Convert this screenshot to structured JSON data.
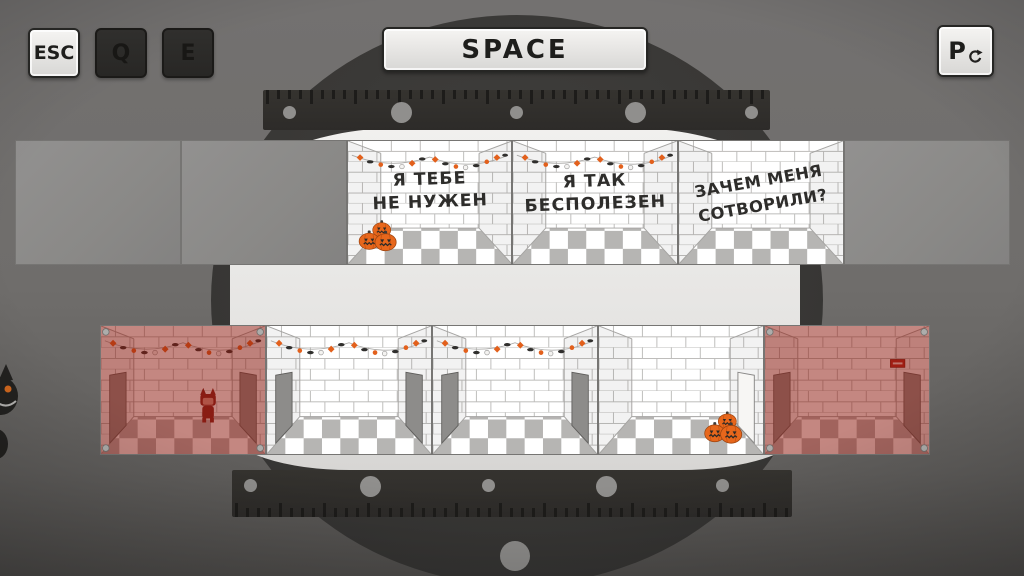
{
  "hud": {
    "keys": {
      "esc": {
        "label": "ESC",
        "state": "active"
      },
      "q": {
        "label": "Q",
        "state": "inactive"
      },
      "e": {
        "label": "E",
        "state": "inactive"
      },
      "space": {
        "label": "SPACE",
        "state": "active"
      },
      "restart": {
        "label": "P",
        "icon": "restart-arrow-icon",
        "state": "active"
      }
    }
  },
  "top_row": {
    "rooms": [
      {
        "kind": "empty-panel"
      },
      {
        "kind": "empty-panel"
      },
      {
        "kind": "message-room",
        "line1": "Я ТЕБЕ",
        "line2": "НЕ НУЖЕН",
        "decor": [
          "halloween-garland",
          "pumpkins-bottom-left"
        ]
      },
      {
        "kind": "message-room",
        "line1": "Я ТАК",
        "line2": "БЕСПОЛЕЗЕН",
        "decor": [
          "halloween-garland"
        ]
      },
      {
        "kind": "message-room",
        "line1": "ЗАЧЕМ МЕНЯ",
        "line2": "СОТВОРИЛИ?",
        "tilted": true,
        "decor": []
      },
      {
        "kind": "empty-panel"
      }
    ]
  },
  "bottom_row": {
    "rooms": [
      {
        "kind": "red-room",
        "decor": [
          "halloween-garland",
          "cat-figure",
          "corner-bolts",
          "left-door",
          "right-door"
        ]
      },
      {
        "kind": "white-room",
        "decor": [
          "halloween-garland",
          "left-door",
          "right-door"
        ]
      },
      {
        "kind": "white-room",
        "decor": [
          "halloween-garland",
          "left-door",
          "right-door"
        ]
      },
      {
        "kind": "white-room",
        "decor": [
          "pumpkins-bottom-right",
          "open-right-door"
        ]
      },
      {
        "kind": "red-room",
        "decor": [
          "left-door",
          "right-door",
          "exit-sign",
          "corner-bolts"
        ]
      }
    ]
  },
  "colors": {
    "background": "#6e6c6a",
    "vault_circle": "#393836",
    "platform_white": "#e9e8e6",
    "halloween_orange": "#e2601c",
    "red_room_tint": "#8e180d",
    "brick_line": "#bdbcba",
    "floor_checker": "#b6b5b3",
    "key_light_face": "#e9e8e6",
    "key_dark_face": "#2b2a28"
  }
}
